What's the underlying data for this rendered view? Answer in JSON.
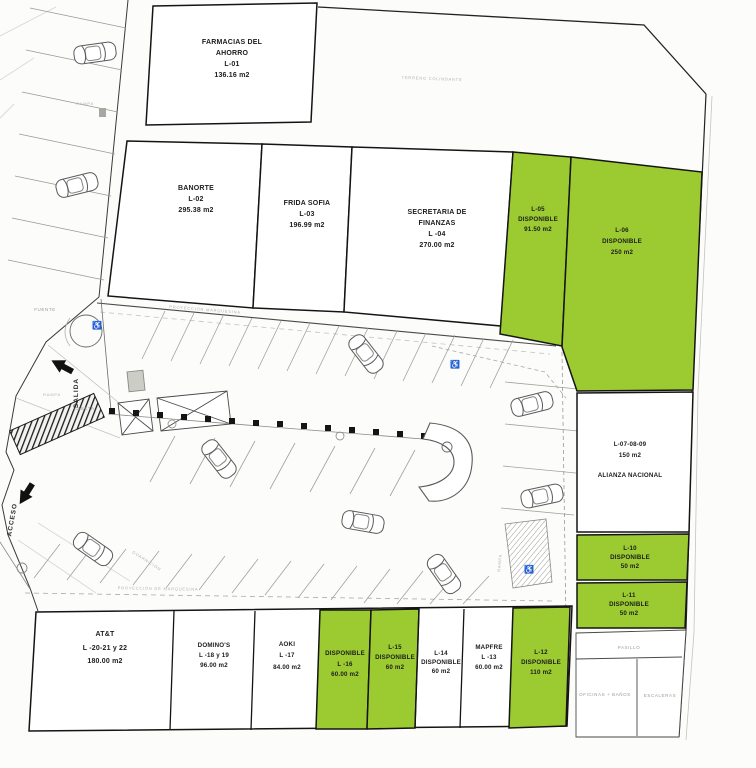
{
  "colors": {
    "available": "#9ccb31",
    "lot_border": "#141414"
  },
  "icons": {
    "wheelchair": "♿"
  },
  "site": {
    "terrain_label": "TERRENO COLINDANTE",
    "marquee_top": "PROYECCIÓN MARQUESINA",
    "marquee_bottom": "PROYECCIÓN DE MARQUESINA",
    "fuente": "FUENTE",
    "salida": "SALIDA",
    "acceso": "ACCESO",
    "rampa": "RAMPA",
    "caseta": "CASETA",
    "guarnicion": "GUARNICIÓN",
    "pasillo": "PASILLO",
    "oficinas": "OFICINAS + BAÑOS",
    "escaleras": "ESCALERAS"
  },
  "lots": {
    "l01": {
      "available": false,
      "lines": [
        "FARMACIAS DEL",
        "AHORRO",
        "L-01",
        "136.16 m2"
      ]
    },
    "l02": {
      "available": false,
      "lines": [
        "BANORTE",
        "L-02",
        "295.38 m2"
      ]
    },
    "l03": {
      "available": false,
      "lines": [
        "FRIDA SOFIA",
        "L-03",
        "196.99 m2"
      ]
    },
    "l04": {
      "available": false,
      "lines": [
        "SECRETARIA DE",
        "FINANZAS",
        "L -04",
        "270.00 m2"
      ]
    },
    "l05": {
      "available": true,
      "lines": [
        "L-05",
        "DISPONIBLE",
        "91.50  m2"
      ]
    },
    "l06": {
      "available": true,
      "lines": [
        "L-06",
        "DISPONIBLE",
        "250  m2"
      ]
    },
    "l0789": {
      "available": false,
      "lines": [
        "L-07-08-09",
        "150  m2",
        "ALIANZA NACIONAL"
      ]
    },
    "l10": {
      "available": true,
      "lines": [
        "L-10",
        "DISPONIBLE",
        "50  m2"
      ]
    },
    "l11": {
      "available": true,
      "lines": [
        "L-11",
        "DISPONIBLE",
        "50  m2"
      ]
    },
    "l12": {
      "available": true,
      "lines": [
        "L-12",
        "DISPONIBLE",
        "110  m2"
      ]
    },
    "l13": {
      "available": false,
      "lines": [
        "MAPFRE",
        "L -13",
        "60.00 m2"
      ]
    },
    "l14": {
      "available": false,
      "lines": [
        "L-14",
        "DISPONIBLE",
        "60  m2"
      ]
    },
    "l15": {
      "available": true,
      "lines": [
        "L-15",
        "DISPONIBLE",
        "60  m2"
      ]
    },
    "l16": {
      "available": true,
      "lines": [
        "DISPONIBLE",
        "L -16",
        "60.00 m2"
      ]
    },
    "l17": {
      "available": false,
      "lines": [
        "AOKI",
        "L -17",
        "84.00 m2"
      ]
    },
    "l1819": {
      "available": false,
      "lines": [
        "DOMINO'S",
        "L -18 y 19",
        "96.00 m2"
      ]
    },
    "l2022": {
      "available": false,
      "lines": [
        "AT&T",
        "L -20-21 y 22",
        "180.00 m2"
      ]
    }
  }
}
